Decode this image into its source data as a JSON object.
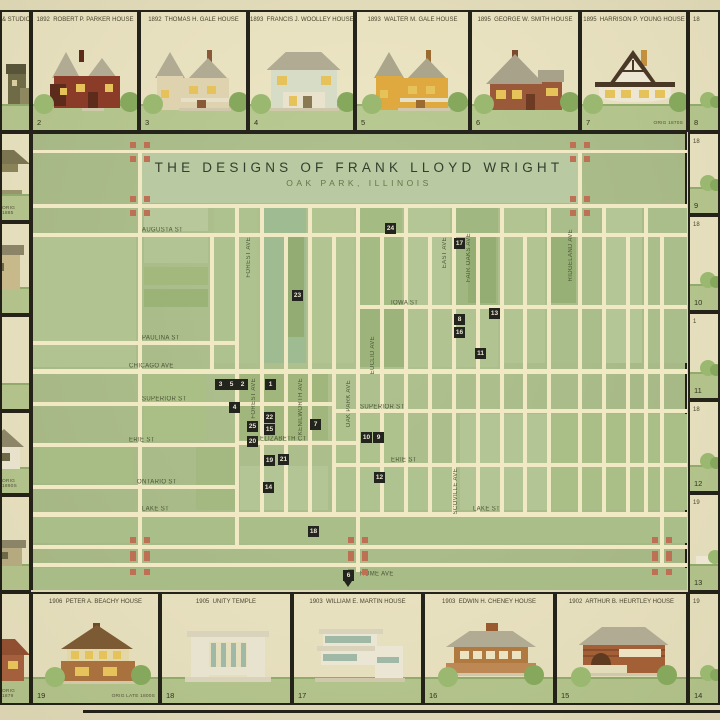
{
  "title": {
    "main": "THE DESIGNS OF FRANK LLOYD WRIGHT",
    "sub": "OAK PARK, ILLINOIS"
  },
  "colors": {
    "parchment": "#e8e1bf",
    "cellbg": "#efe8c6",
    "frame": "#1c1b14",
    "mapbg": "#abbf8b",
    "band": "#b9c9a1",
    "street": "#f0e9c3",
    "labelc": "#4d5637",
    "markerbg": "#22241d",
    "markerfg": "#eae6d2",
    "terracotta": "#bd7054",
    "grass": "#b7ca90",
    "grassline": "#94b06f",
    "bush": "#9ab86f",
    "bush2": "#86a85c"
  },
  "map": {
    "x": 31,
    "y": 132,
    "w": 656,
    "h": 458,
    "title_band": {
      "x": 140,
      "y": 153,
      "w": 438,
      "h": 50
    },
    "streets_h": [
      [
        33,
        150,
        654,
        3
      ],
      [
        33,
        204,
        654,
        4
      ],
      [
        33,
        233,
        654,
        4
      ],
      [
        357,
        305,
        330,
        4
      ],
      [
        33,
        341,
        202,
        4
      ],
      [
        33,
        369,
        654,
        5
      ],
      [
        33,
        402,
        299,
        4
      ],
      [
        332,
        409,
        355,
        4
      ],
      [
        237,
        441,
        120,
        4
      ],
      [
        33,
        443,
        204,
        4
      ],
      [
        332,
        463,
        355,
        4
      ],
      [
        33,
        485,
        204,
        4
      ],
      [
        33,
        512,
        654,
        5
      ],
      [
        33,
        545,
        654,
        4
      ],
      [
        33,
        563,
        654,
        4
      ]
    ],
    "streets_v": [
      [
        138,
        150,
        4,
        417
      ],
      [
        578,
        150,
        4,
        366
      ],
      [
        210,
        233,
        4,
        140
      ],
      [
        235,
        204,
        4,
        343
      ],
      [
        260,
        204,
        4,
        310
      ],
      [
        284,
        233,
        4,
        281
      ],
      [
        308,
        204,
        4,
        310
      ],
      [
        332,
        233,
        4,
        281
      ],
      [
        356,
        204,
        4,
        310
      ],
      [
        356,
        512,
        4,
        60
      ],
      [
        380,
        233,
        4,
        281
      ],
      [
        404,
        204,
        4,
        310
      ],
      [
        428,
        233,
        4,
        281
      ],
      [
        452,
        204,
        4,
        312
      ],
      [
        476,
        233,
        4,
        281
      ],
      [
        500,
        204,
        4,
        310
      ],
      [
        523,
        233,
        4,
        281
      ],
      [
        547,
        204,
        4,
        310
      ],
      [
        602,
        204,
        4,
        310
      ],
      [
        626,
        233,
        4,
        281
      ],
      [
        644,
        204,
        4,
        310
      ],
      [
        660,
        233,
        4,
        334
      ]
    ],
    "blocks": [
      [
        144,
        208,
        64,
        23,
        "#b8c89b"
      ],
      [
        214,
        208,
        44,
        155,
        "#adc28e"
      ],
      [
        264,
        208,
        42,
        155,
        "#9fbb92"
      ],
      [
        312,
        208,
        42,
        155,
        "#b1c492"
      ],
      [
        360,
        208,
        42,
        155,
        "#a5bb84"
      ],
      [
        408,
        208,
        42,
        155,
        "#b5c696"
      ],
      [
        456,
        208,
        42,
        155,
        "#a0b781"
      ],
      [
        504,
        208,
        41,
        155,
        "#b1c492"
      ],
      [
        551,
        208,
        49,
        155,
        "#a9be8a"
      ],
      [
        606,
        208,
        36,
        155,
        "#b5c696"
      ],
      [
        648,
        208,
        39,
        155,
        "#a9be8a"
      ],
      [
        288,
        237,
        16,
        100,
        "#92ac74"
      ],
      [
        468,
        237,
        28,
        66,
        "#93ad72"
      ],
      [
        551,
        237,
        25,
        66,
        "#96b075"
      ],
      [
        33,
        237,
        103,
        130,
        "#b0c391"
      ],
      [
        144,
        237,
        64,
        26,
        "#b2c493"
      ],
      [
        144,
        267,
        64,
        18,
        "#a2b87d"
      ],
      [
        144,
        289,
        64,
        18,
        "#9cb377"
      ],
      [
        360,
        309,
        44,
        58,
        "#9cb37b"
      ],
      [
        408,
        309,
        90,
        58,
        "#b0c391"
      ],
      [
        240,
        373,
        88,
        67,
        "#a0b67c"
      ],
      [
        144,
        373,
        62,
        67,
        "#aabf86"
      ],
      [
        33,
        445,
        100,
        38,
        "#a8bd85"
      ],
      [
        196,
        447,
        39,
        63,
        "#a3b981"
      ],
      [
        240,
        466,
        88,
        44,
        "#b3c594"
      ],
      [
        336,
        414,
        68,
        47,
        "#adc28c"
      ],
      [
        336,
        467,
        120,
        43,
        "#afc390"
      ],
      [
        460,
        414,
        88,
        96,
        "#b3c594"
      ],
      [
        552,
        414,
        135,
        96,
        "#aabf88"
      ],
      [
        33,
        516,
        654,
        27,
        "#a9be88"
      ],
      [
        33,
        568,
        654,
        22,
        "#a7bc86"
      ]
    ],
    "labels_h": [
      [
        "AUGUSTA ST",
        142,
        227
      ],
      [
        "IOWA ST",
        391,
        300
      ],
      [
        "PAULINA ST",
        142,
        335
      ],
      [
        "CHICAGO AVE",
        129,
        363
      ],
      [
        "SUPERIOR ST",
        142,
        396
      ],
      [
        "SUPERIOR ST",
        360,
        404
      ],
      [
        "ELIZABETH CT",
        260,
        436
      ],
      [
        "ERIE ST",
        129,
        437
      ],
      [
        "ERIE ST",
        391,
        457
      ],
      [
        "ONTARIO ST",
        137,
        479
      ],
      [
        "LAKE ST",
        142,
        506
      ],
      [
        "LAKE ST",
        473,
        506
      ],
      [
        "HOME AVE",
        360,
        571
      ]
    ],
    "labels_v": [
      [
        "FOREST AVE",
        246,
        237
      ],
      [
        "FOREST AVE",
        251,
        378
      ],
      [
        "KENILWORTH AVE",
        298,
        378
      ],
      [
        "OAK PARK AVE",
        346,
        380
      ],
      [
        "EUCLID AVE",
        370,
        336
      ],
      [
        "EAST AVE",
        442,
        237
      ],
      [
        "FAIR OAKS AVE",
        466,
        233
      ],
      [
        "RIDGELAND AVE",
        568,
        229
      ],
      [
        "SCOVILLE AVE",
        453,
        468
      ]
    ],
    "markers": [
      [
        "3",
        220,
        384
      ],
      [
        "5",
        231,
        384
      ],
      [
        "2",
        242,
        384
      ],
      [
        "1",
        270,
        384
      ],
      [
        "4",
        234,
        407
      ],
      [
        "22",
        269,
        417
      ],
      [
        "25",
        252,
        426
      ],
      [
        "15",
        269,
        429
      ],
      [
        "20",
        252,
        441
      ],
      [
        "19",
        269,
        460
      ],
      [
        "21",
        283,
        459
      ],
      [
        "14",
        268,
        487
      ],
      [
        "7",
        315,
        424
      ],
      [
        "10",
        366,
        437
      ],
      [
        "9",
        378,
        437
      ],
      [
        "12",
        379,
        477
      ],
      [
        "18",
        313,
        531
      ],
      [
        "6",
        348,
        575
      ],
      [
        "23",
        297,
        295
      ],
      [
        "24",
        390,
        228
      ],
      [
        "17",
        459,
        243
      ],
      [
        "8",
        459,
        319
      ],
      [
        "16",
        459,
        332
      ],
      [
        "13",
        494,
        313
      ],
      [
        "11",
        480,
        353
      ]
    ],
    "crosses": [
      [
        138,
        150
      ],
      [
        578,
        150
      ],
      [
        138,
        204
      ],
      [
        578,
        204
      ],
      [
        138,
        545
      ],
      [
        356,
        545
      ],
      [
        660,
        545
      ],
      [
        138,
        563
      ],
      [
        356,
        563
      ],
      [
        660,
        563
      ]
    ],
    "home_arrow": {
      "x": 344,
      "y": 581
    }
  },
  "border_cells": [
    {
      "id": "cell-studio",
      "x": 0,
      "y": 10,
      "w": 31,
      "h": 122,
      "caption": "& STUDIO",
      "cap_align": "right",
      "num": "",
      "note": "",
      "house": {
        "kind": "studioPartial"
      }
    },
    {
      "id": "cell-2",
      "x": 31,
      "y": 10,
      "w": 108,
      "h": 122,
      "caption": "1892  ROBERT P. PARKER HOUSE",
      "num": "2",
      "note": "",
      "house": {
        "kind": "queenAnne",
        "body": "#8b3c28",
        "roof": "#b2ab93",
        "trim": "#5d2b1c",
        "win": "#e6c35a"
      }
    },
    {
      "id": "cell-3",
      "x": 139,
      "y": 10,
      "w": 109,
      "h": 122,
      "caption": "1892  THOMAS H. GALE HOUSE",
      "num": "3",
      "note": "",
      "house": {
        "kind": "turret",
        "body": "#ded3ae",
        "roof": "#b2ab93",
        "trim": "#8a5a38",
        "win": "#e6c35a"
      }
    },
    {
      "id": "cell-4",
      "x": 248,
      "y": 10,
      "w": 107,
      "h": 122,
      "caption": "1893  FRANCIS J. WOOLLEY HOUSE",
      "num": "4",
      "note": "",
      "house": {
        "kind": "hip2",
        "body": "#d6dcc6",
        "roof": "#b2ab93",
        "trim": "#8a7a54",
        "win": "#e6c35a"
      }
    },
    {
      "id": "cell-5",
      "x": 355,
      "y": 10,
      "w": 115,
      "h": 122,
      "caption": "1893  WALTER M. GALE HOUSE",
      "num": "5",
      "note": "",
      "house": {
        "kind": "turret",
        "body": "#dfa93f",
        "roof": "#aaa58b",
        "trim": "#9a6a30",
        "win": "#e6c35a"
      }
    },
    {
      "id": "cell-6",
      "x": 470,
      "y": 10,
      "w": 110,
      "h": 122,
      "caption": "1895  GEORGE W. SMITH HOUSE",
      "num": "6",
      "note": "",
      "house": {
        "kind": "gableB",
        "body": "#9a5a3a",
        "roof": "#a8a28a",
        "trim": "#6d3b24",
        "win": "#e6c35a"
      }
    },
    {
      "id": "cell-7",
      "x": 580,
      "y": 10,
      "w": 108,
      "h": 122,
      "caption": "1895  HARRISON P. YOUNG HOUSE",
      "num": "7",
      "note": "ORIG 1870S",
      "house": {
        "kind": "tudor",
        "body": "#ece6d2",
        "roof": "#a8a28a",
        "trim": "#4a3826",
        "win": "#e6c35a"
      }
    },
    {
      "id": "cell-8",
      "x": 688,
      "y": 10,
      "w": 32,
      "h": 122,
      "caption": "18",
      "cap_align": "left",
      "num": "8",
      "note": "",
      "house": {
        "kind": "bushR"
      }
    },
    {
      "id": "cell-9",
      "x": 688,
      "y": 132,
      "w": 32,
      "h": 83,
      "caption": "18",
      "cap_align": "left",
      "num": "9",
      "note": "",
      "house": {
        "kind": "bushR"
      }
    },
    {
      "id": "cell-10",
      "x": 688,
      "y": 215,
      "w": 32,
      "h": 97,
      "caption": "18",
      "cap_align": "left",
      "num": "10",
      "note": "",
      "house": {
        "kind": "bushR"
      }
    },
    {
      "id": "cell-11",
      "x": 688,
      "y": 312,
      "w": 32,
      "h": 88,
      "caption": "1",
      "cap_align": "left",
      "num": "11",
      "note": "",
      "house": {
        "kind": "bushR"
      }
    },
    {
      "id": "cell-12",
      "x": 688,
      "y": 400,
      "w": 32,
      "h": 93,
      "caption": "18",
      "cap_align": "left",
      "num": "12",
      "note": "",
      "house": {
        "kind": "bushR"
      }
    },
    {
      "id": "cell-13",
      "x": 688,
      "y": 493,
      "w": 32,
      "h": 99,
      "caption": "19",
      "cap_align": "left",
      "num": "13",
      "note": "",
      "house": {
        "kind": "fragR"
      }
    },
    {
      "id": "cell-l1",
      "x": 0,
      "y": 132,
      "w": 31,
      "h": 90,
      "caption": "",
      "num": "",
      "note": "ORIG 1885",
      "house": {
        "kind": "pavL"
      }
    },
    {
      "id": "cell-l2",
      "x": 0,
      "y": 222,
      "w": 31,
      "h": 93,
      "caption": "",
      "num": "",
      "note": "",
      "house": {
        "kind": "boxL"
      }
    },
    {
      "id": "cell-l3",
      "x": 0,
      "y": 315,
      "w": 31,
      "h": 96,
      "caption": "",
      "num": "",
      "note": "",
      "house": {
        "kind": "roofL2"
      }
    },
    {
      "id": "cell-l4",
      "x": 0,
      "y": 411,
      "w": 31,
      "h": 84,
      "caption": "",
      "num": "",
      "note": "ORIG 1890S",
      "house": {
        "kind": "smallL"
      }
    },
    {
      "id": "cell-l5",
      "x": 0,
      "y": 495,
      "w": 31,
      "h": 97,
      "caption": "",
      "num": "",
      "note": "",
      "house": {
        "kind": "lowL"
      }
    },
    {
      "id": "cell-bl",
      "x": 0,
      "y": 592,
      "w": 31,
      "h": 113,
      "caption": "",
      "num": "",
      "note": "ORIG 1879",
      "house": {
        "kind": "roofL",
        "body": "#a4603c",
        "roof": "#8f4f30"
      }
    },
    {
      "id": "cell-19",
      "x": 31,
      "y": 592,
      "w": 129,
      "h": 113,
      "caption": "1906  PETER A. BEACHY HOUSE",
      "num": "19",
      "note": "ORIG LATE 1800S",
      "house": {
        "kind": "beachy",
        "body": "#a9713d",
        "roof": "#7c5a33",
        "trim": "#e3d7a8",
        "win": "#e6c35a"
      }
    },
    {
      "id": "cell-18",
      "x": 160,
      "y": 592,
      "w": 132,
      "h": 113,
      "caption": "1905  UNITY TEMPLE",
      "num": "18",
      "note": "",
      "house": {
        "kind": "unity",
        "body": "#e8e3cf",
        "roof": "#d6d0b8",
        "trim": "#9fb9a6",
        "win": "#9fb9a6"
      }
    },
    {
      "id": "cell-17",
      "x": 292,
      "y": 592,
      "w": 131,
      "h": 113,
      "caption": "1903  WILLIAM E. MARTIN HOUSE",
      "num": "17",
      "note": "",
      "house": {
        "kind": "martin",
        "body": "#ebe6d3",
        "roof": "#d6d0b8",
        "trim": "#9fb9a6",
        "win": "#e6c35a"
      }
    },
    {
      "id": "cell-16",
      "x": 423,
      "y": 592,
      "w": 132,
      "h": 113,
      "caption": "1903  EDWIN H. CHENEY HOUSE",
      "num": "16",
      "note": "",
      "house": {
        "kind": "cheney",
        "body": "#b0793f",
        "roof": "#b2ab93",
        "trim": "#8a5a2f",
        "win": "#ece3c2"
      }
    },
    {
      "id": "cell-15",
      "x": 555,
      "y": 592,
      "w": 133,
      "h": 113,
      "caption": "1902  ARTHUR B. HEURTLEY HOUSE",
      "num": "15",
      "note": "",
      "house": {
        "kind": "heurtley",
        "body": "#a35f35",
        "roof": "#b2ab93",
        "trim": "#5d3a20",
        "win": "#ece3c2"
      }
    },
    {
      "id": "cell-14",
      "x": 688,
      "y": 592,
      "w": 32,
      "h": 113,
      "caption": "19",
      "cap_align": "left",
      "num": "14",
      "note": "",
      "house": {
        "kind": "bushR"
      }
    }
  ],
  "bottom_edge_line": {
    "x": 83,
    "y": 710,
    "w": 637,
    "h": 3
  }
}
